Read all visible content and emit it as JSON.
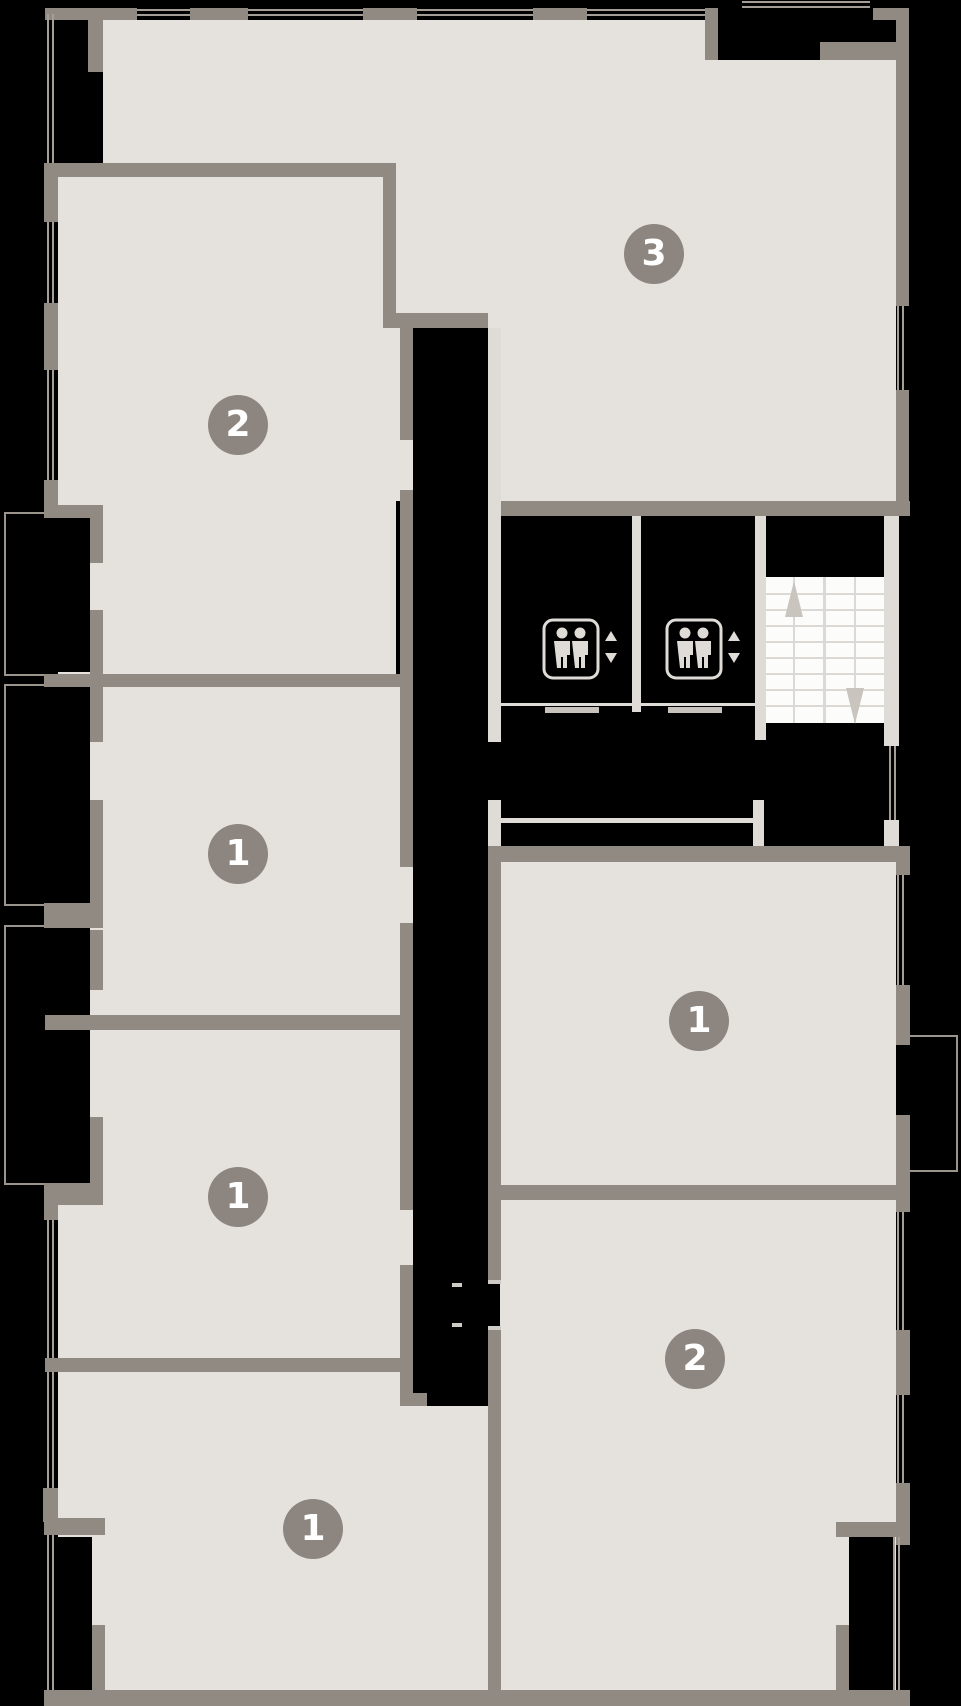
{
  "plan": {
    "type": "residential-floor-plan",
    "units": [
      {
        "id": "unit-top-left",
        "label": "2"
      },
      {
        "id": "unit-top-right",
        "label": "3"
      },
      {
        "id": "unit-left-middle",
        "label": "1"
      },
      {
        "id": "unit-left-lower",
        "label": "1"
      },
      {
        "id": "unit-bottom-left",
        "label": "1"
      },
      {
        "id": "unit-right-middle",
        "label": "1"
      },
      {
        "id": "unit-bottom-right",
        "label": "2"
      }
    ],
    "core": {
      "elevator_count": 2,
      "elevator_icon": "two-person-elevator-icon",
      "elevator_indicators": [
        "up-triangle",
        "down-triangle"
      ],
      "stairs": {
        "flights": 2,
        "arrows": [
          "up",
          "down"
        ]
      }
    },
    "colors": {
      "background": "#000000",
      "floor": "#e5e2dd",
      "unit_wall": "#918a83",
      "core_wall": "#dfdcd7",
      "stair_fill": "#fcfcfb",
      "stair_tread": "#dcd8d3",
      "window_line": "#a49e97",
      "balcony_outline": "#9b948d",
      "label_circle": "#8d8680",
      "label_text": "#ffffff"
    }
  }
}
